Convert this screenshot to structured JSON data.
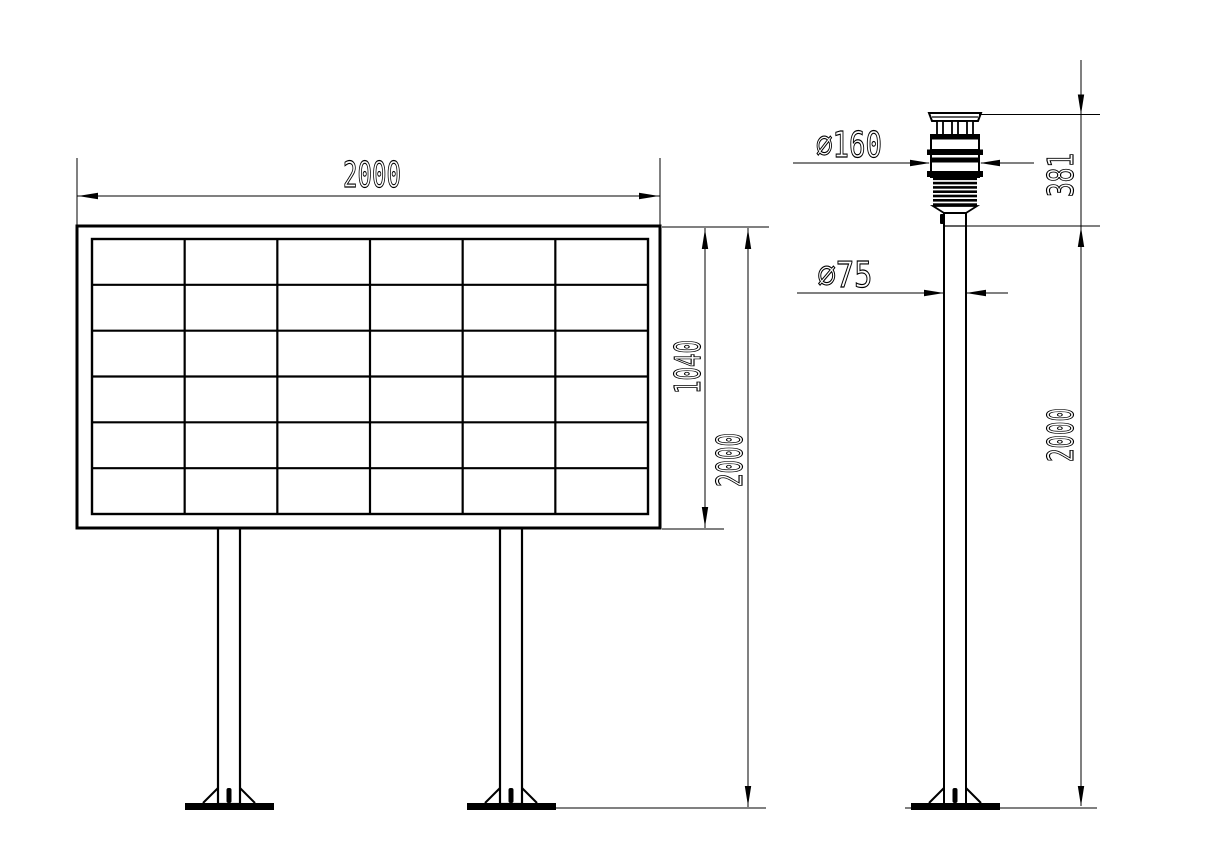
{
  "drawing": {
    "background_color": "#ffffff",
    "line_color": "#000000",
    "front_view": {
      "title": "display board front view",
      "width_dim": "2000",
      "panel_height_dim": "1040",
      "overall_height_dim": "2000",
      "grid": {
        "rows": 6,
        "cols": 6
      }
    },
    "side_view": {
      "title": "weather sensor pole side view",
      "sensor_diameter_dim": "∅160",
      "pole_diameter_dim": "∅75",
      "sensor_height_dim": "381",
      "overall_height_dim": "2000"
    }
  }
}
